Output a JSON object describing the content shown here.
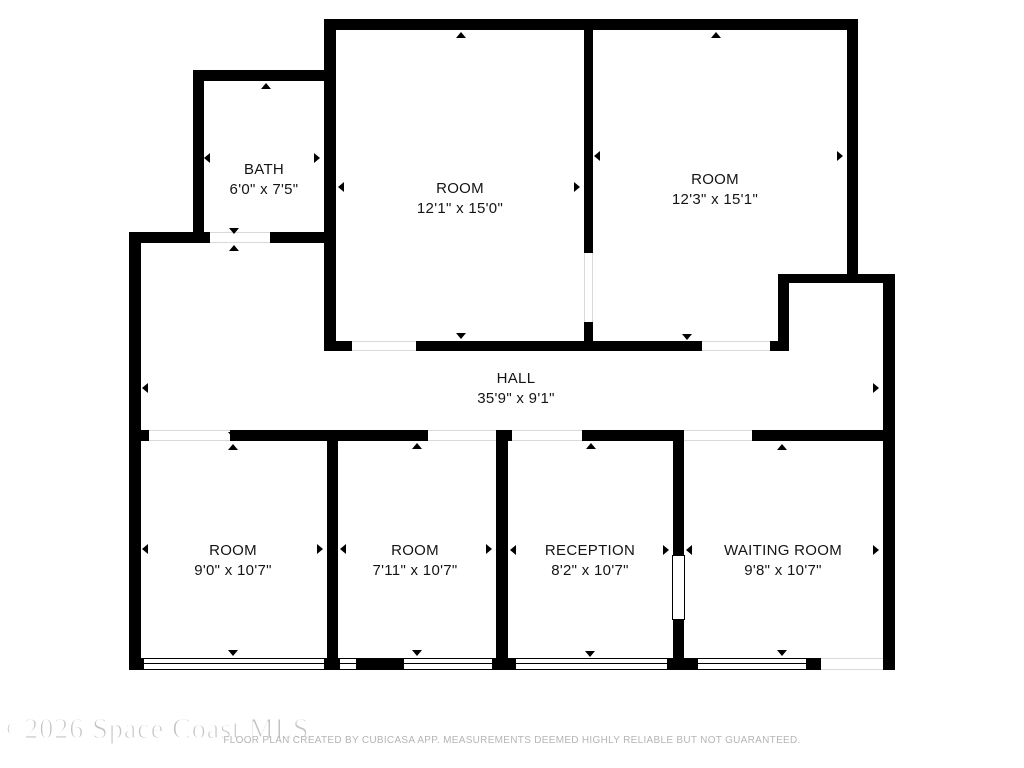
{
  "floor_plan": {
    "type": "floor-plan",
    "rooms": {
      "bath": {
        "name": "BATH",
        "dimensions": "6'0\" x 7'5\""
      },
      "room_top_left": {
        "name": "ROOM",
        "dimensions": "12'1\" x 15'0\""
      },
      "room_top_right": {
        "name": "ROOM",
        "dimensions": "12'3\" x 15'1\""
      },
      "hall": {
        "name": "HALL",
        "dimensions": "35'9\" x 9'1\""
      },
      "room_bottom_left": {
        "name": "ROOM",
        "dimensions": "9'0\" x 10'7\""
      },
      "room_bottom_mid": {
        "name": "ROOM",
        "dimensions": "7'11\" x 10'7\""
      },
      "reception": {
        "name": "RECEPTION",
        "dimensions": "8'2\" x 10'7\""
      },
      "waiting_room": {
        "name": "WAITING ROOM",
        "dimensions": "9'8\" x 10'7\""
      }
    }
  },
  "footer": {
    "watermark": "©2026 Space Coast MLS",
    "disclaimer": "FLOOR PLAN CREATED BY CUBICASA APP. MEASUREMENTS DEEMED HIGHLY RELIABLE BUT NOT GUARANTEED."
  },
  "colors": {
    "wall": "#000000",
    "background": "#ffffff",
    "watermark_text": "#c3c3c3",
    "disclaimer_text": "#b5b5b5"
  }
}
